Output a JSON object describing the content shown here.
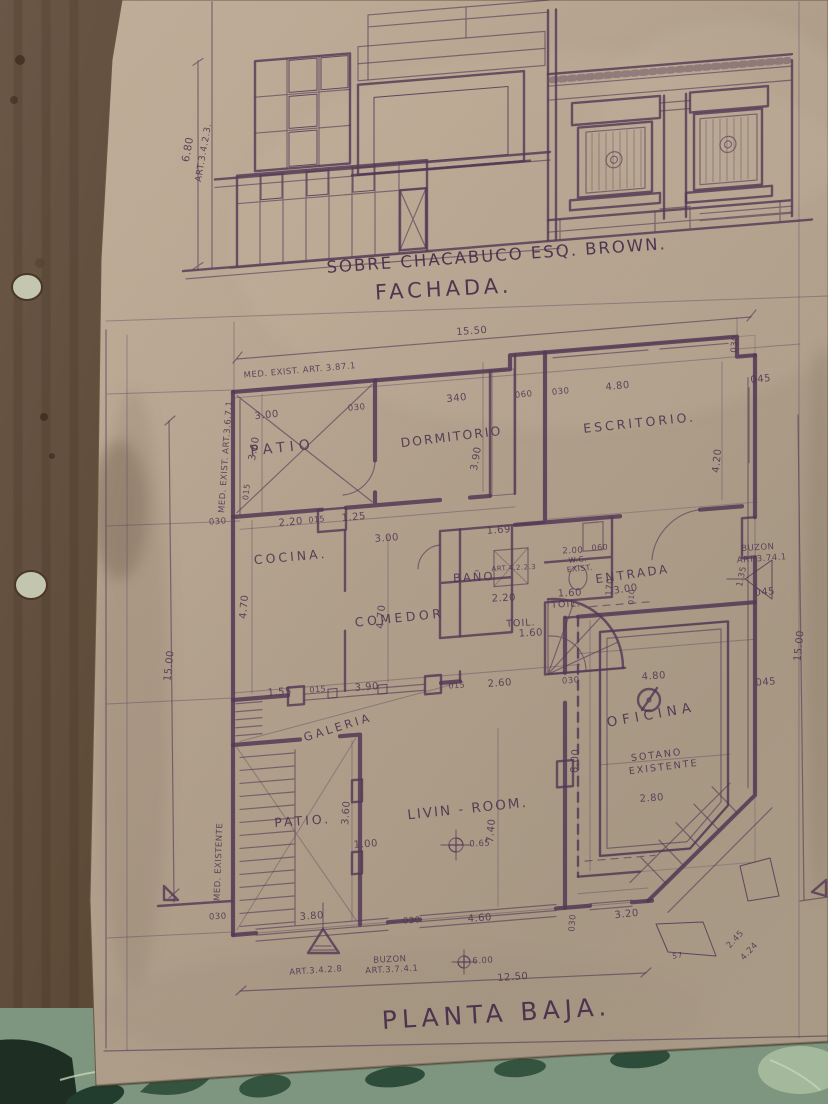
{
  "photo": {
    "paper_color": "#b5a28e",
    "ink_color": "#543956",
    "wood_color": "#5c4a3a",
    "fabric_color": "#7e957f"
  },
  "captions": {
    "street": "SOBRE CHACABUCO ESQ. BROWN.",
    "facade_title": "FACHADA.",
    "plan_title": "PLANTA BAJA."
  },
  "labels": {
    "facade": [
      {
        "t": "6.80",
        "x": 191,
        "y": 150,
        "r": -80
      },
      {
        "t": "ART.3.4.2.3.",
        "x": 206,
        "y": 153,
        "r": -80,
        "fs": 9
      }
    ],
    "rooms": [
      {
        "t": "PATIO",
        "x": 283,
        "y": 452,
        "r": -6,
        "fs": 14,
        "ls": 5
      },
      {
        "t": "DORMITORIO",
        "x": 452,
        "y": 441,
        "r": -7,
        "fs": 12.5,
        "ls": 2
      },
      {
        "t": "ESCRITORIO.",
        "x": 640,
        "y": 427,
        "r": -6,
        "fs": 12.5,
        "ls": 3
      },
      {
        "t": "COCINA.",
        "x": 291,
        "y": 561,
        "r": -5,
        "fs": 12.5,
        "ls": 3
      },
      {
        "t": "COMEDOR",
        "x": 400,
        "y": 622,
        "r": -6,
        "fs": 12.5,
        "ls": 3.5
      },
      {
        "t": "BAÑO",
        "x": 474,
        "y": 581,
        "r": -3,
        "fs": 11.5,
        "ls": 2
      },
      {
        "t": "TOIL.",
        "x": 521,
        "y": 626,
        "r": -3,
        "fs": 9.5,
        "ls": 1
      },
      {
        "t": "TOIL.",
        "x": 566,
        "y": 607,
        "r": -3,
        "fs": 9.5,
        "ls": 1
      },
      {
        "t": "W.C.",
        "x": 578,
        "y": 562,
        "r": -6,
        "fs": 7.5,
        "ls": 0.5
      },
      {
        "t": "EXIST.",
        "x": 580,
        "y": 571,
        "r": -6,
        "fs": 7.5,
        "ls": 0.5
      },
      {
        "t": "ENTRADA",
        "x": 633,
        "y": 578,
        "r": -8,
        "fs": 12,
        "ls": 2.5
      },
      {
        "t": "OFICINA",
        "x": 652,
        "y": 719,
        "r": -10,
        "fs": 13.5,
        "ls": 5
      },
      {
        "t": "SOTANO",
        "x": 657,
        "y": 758,
        "r": -7,
        "fs": 9.5,
        "ls": 2
      },
      {
        "t": "EXISTENTE",
        "x": 664,
        "y": 770,
        "r": -7,
        "fs": 9.5,
        "ls": 2
      },
      {
        "t": "GALERIA",
        "x": 339,
        "y": 731,
        "r": -17,
        "fs": 11.5,
        "ls": 3
      },
      {
        "t": "PATIO.",
        "x": 303,
        "y": 825,
        "r": -4,
        "fs": 12.5,
        "ls": 3
      },
      {
        "t": "LIVIN - ROOM.",
        "x": 468,
        "y": 813,
        "r": -6,
        "fs": 13.5,
        "ls": 2
      }
    ],
    "notes": [
      {
        "t": "MED. EXIST. ART. 3.87.1",
        "x": 300,
        "y": 373,
        "r": -5
      },
      {
        "t": "MED. EXIST. ART.3.6.7.1",
        "x": 228,
        "y": 457,
        "r": -86
      },
      {
        "t": "MED. EXISTENTE",
        "x": 221,
        "y": 862,
        "r": -88
      },
      {
        "t": "BUZON",
        "x": 758,
        "y": 550,
        "r": -4
      },
      {
        "t": "ART.3.74.1",
        "x": 762,
        "y": 561,
        "r": -4
      },
      {
        "t": "ART.4.2.2.3",
        "x": 514,
        "y": 570,
        "r": -3,
        "fs": 7
      },
      {
        "t": "BUZON",
        "x": 390,
        "y": 962,
        "r": -3
      },
      {
        "t": "ART.3.7.4.1",
        "x": 392,
        "y": 972,
        "r": -3
      },
      {
        "t": "ART.3.4.2.8",
        "x": 316,
        "y": 973,
        "r": -4
      }
    ],
    "dims": [
      {
        "t": "15.50",
        "x": 472,
        "y": 334,
        "r": -4
      },
      {
        "t": "030",
        "x": 737,
        "y": 344,
        "r": -86,
        "fs": 8.5
      },
      {
        "t": "045",
        "x": 761,
        "y": 382,
        "r": -6
      },
      {
        "t": "3.00",
        "x": 267,
        "y": 418,
        "r": -6
      },
      {
        "t": "030",
        "x": 357,
        "y": 410,
        "r": -6,
        "fs": 8.5
      },
      {
        "t": "340",
        "x": 457,
        "y": 401,
        "r": -6
      },
      {
        "t": "060",
        "x": 524,
        "y": 397,
        "r": -6,
        "fs": 8.5
      },
      {
        "t": "030",
        "x": 561,
        "y": 394,
        "r": -6,
        "fs": 8.5
      },
      {
        "t": "4.80",
        "x": 618,
        "y": 389,
        "r": -6
      },
      {
        "t": "3.60",
        "x": 257,
        "y": 449,
        "r": -80
      },
      {
        "t": "3.90",
        "x": 479,
        "y": 459,
        "r": -80
      },
      {
        "t": "4.20",
        "x": 720,
        "y": 461,
        "r": -84
      },
      {
        "t": "015",
        "x": 249,
        "y": 492,
        "r": -84,
        "fs": 8
      },
      {
        "t": "030",
        "x": 218,
        "y": 524,
        "r": -4,
        "fs": 8.5
      },
      {
        "t": "2.20",
        "x": 291,
        "y": 525,
        "r": -5
      },
      {
        "t": "015",
        "x": 317,
        "y": 522,
        "r": -5,
        "fs": 8
      },
      {
        "t": "1.25",
        "x": 354,
        "y": 520,
        "r": -5
      },
      {
        "t": "3.00",
        "x": 387,
        "y": 541,
        "r": -4
      },
      {
        "t": "1.69",
        "x": 499,
        "y": 533,
        "r": -4
      },
      {
        "t": "4.70",
        "x": 247,
        "y": 607,
        "r": -85
      },
      {
        "t": "4.70",
        "x": 384,
        "y": 617,
        "r": -85
      },
      {
        "t": "2.20",
        "x": 504,
        "y": 601,
        "r": -3
      },
      {
        "t": "1.60",
        "x": 531,
        "y": 636,
        "r": -3
      },
      {
        "t": "1.60",
        "x": 570,
        "y": 596,
        "r": -3
      },
      {
        "t": "2.00",
        "x": 573,
        "y": 553,
        "r": -3,
        "fs": 8.5
      },
      {
        "t": "060",
        "x": 600,
        "y": 550,
        "r": -3,
        "fs": 8
      },
      {
        "t": "170",
        "x": 612,
        "y": 587,
        "r": -86,
        "fs": 8.5
      },
      {
        "t": "3.00",
        "x": 626,
        "y": 592,
        "r": -8
      },
      {
        "t": "010",
        "x": 634,
        "y": 597,
        "r": -86,
        "fs": 7.5
      },
      {
        "t": "1.35",
        "x": 744,
        "y": 577,
        "r": -78,
        "fs": 8.5
      },
      {
        "t": "045",
        "x": 765,
        "y": 595,
        "r": -5
      },
      {
        "t": "15.00",
        "x": 802,
        "y": 646,
        "r": -84
      },
      {
        "t": "15.00",
        "x": 172,
        "y": 666,
        "r": -84
      },
      {
        "t": "1.55",
        "x": 280,
        "y": 695,
        "r": -4
      },
      {
        "t": "015",
        "x": 318,
        "y": 692,
        "r": -4,
        "fs": 8
      },
      {
        "t": "3.90",
        "x": 367,
        "y": 690,
        "r": -4
      },
      {
        "t": "015",
        "x": 457,
        "y": 688,
        "r": -4,
        "fs": 8
      },
      {
        "t": "2.60",
        "x": 500,
        "y": 686,
        "r": -4
      },
      {
        "t": "030",
        "x": 571,
        "y": 683,
        "r": -4,
        "fs": 8.5
      },
      {
        "t": "4.80",
        "x": 654,
        "y": 679,
        "r": -4
      },
      {
        "t": "045",
        "x": 766,
        "y": 685,
        "r": -4
      },
      {
        "t": "8.00",
        "x": 578,
        "y": 761,
        "r": -87
      },
      {
        "t": "2.80",
        "x": 652,
        "y": 801,
        "r": -4
      },
      {
        "t": "3.60",
        "x": 349,
        "y": 813,
        "r": -86
      },
      {
        "t": "1.00",
        "x": 366,
        "y": 847,
        "r": -4
      },
      {
        "t": "7.40",
        "x": 494,
        "y": 831,
        "r": -85
      },
      {
        "t": "0.65",
        "x": 480,
        "y": 846,
        "r": -3,
        "fs": 8.5
      },
      {
        "t": "030",
        "x": 218,
        "y": 919,
        "r": -3,
        "fs": 8.5
      },
      {
        "t": "3.80",
        "x": 312,
        "y": 919,
        "r": -4
      },
      {
        "t": "030",
        "x": 412,
        "y": 923,
        "r": -4,
        "fs": 8.5
      },
      {
        "t": "4.60",
        "x": 480,
        "y": 921,
        "r": -4
      },
      {
        "t": "030",
        "x": 575,
        "y": 923,
        "r": -86,
        "fs": 8.5
      },
      {
        "t": "3.20",
        "x": 627,
        "y": 917,
        "r": -6
      },
      {
        "t": "2.45",
        "x": 737,
        "y": 941,
        "r": -47,
        "fs": 8.5
      },
      {
        "t": "4.24",
        "x": 751,
        "y": 953,
        "r": -47,
        "fs": 8.5
      },
      {
        "t": "57",
        "x": 678,
        "y": 958,
        "r": -10,
        "fs": 7.5
      },
      {
        "t": "6.00",
        "x": 483,
        "y": 963,
        "r": -3,
        "fs": 8.5
      },
      {
        "t": "12.50",
        "x": 513,
        "y": 980,
        "r": -4
      }
    ]
  }
}
